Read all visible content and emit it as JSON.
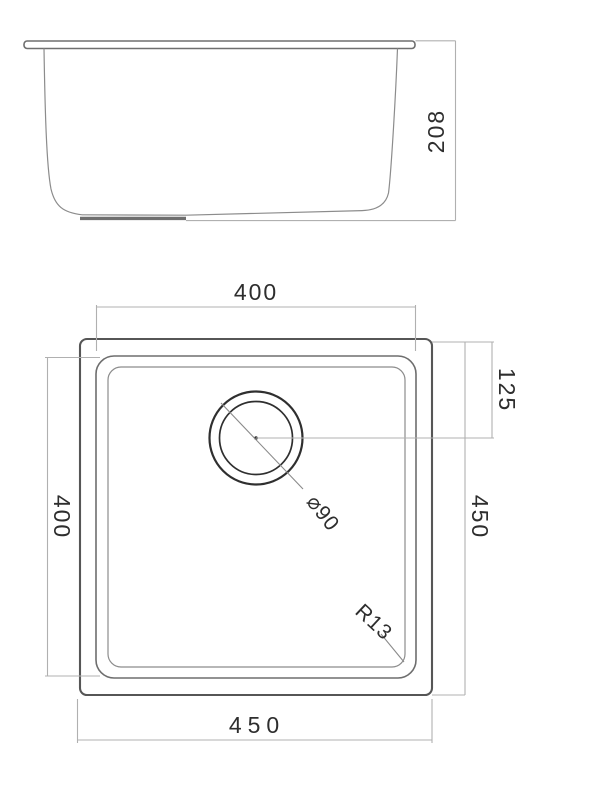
{
  "drawing": {
    "title": "sink-technical-drawing",
    "colors": {
      "background": "#ffffff",
      "geometry": "#6e6e6e",
      "dimension_lines": "#b0b0b0",
      "text": "#2e2e2e"
    },
    "side_view": {
      "depth_label": "208"
    },
    "top_view": {
      "bowl_width_label": "400",
      "bowl_depth_label": "400",
      "drain_offset_label": "125",
      "overall_depth_label": "450",
      "overall_width_label": "450",
      "drain_diameter_label": "⌀90",
      "corner_radius_label": "R13"
    }
  }
}
